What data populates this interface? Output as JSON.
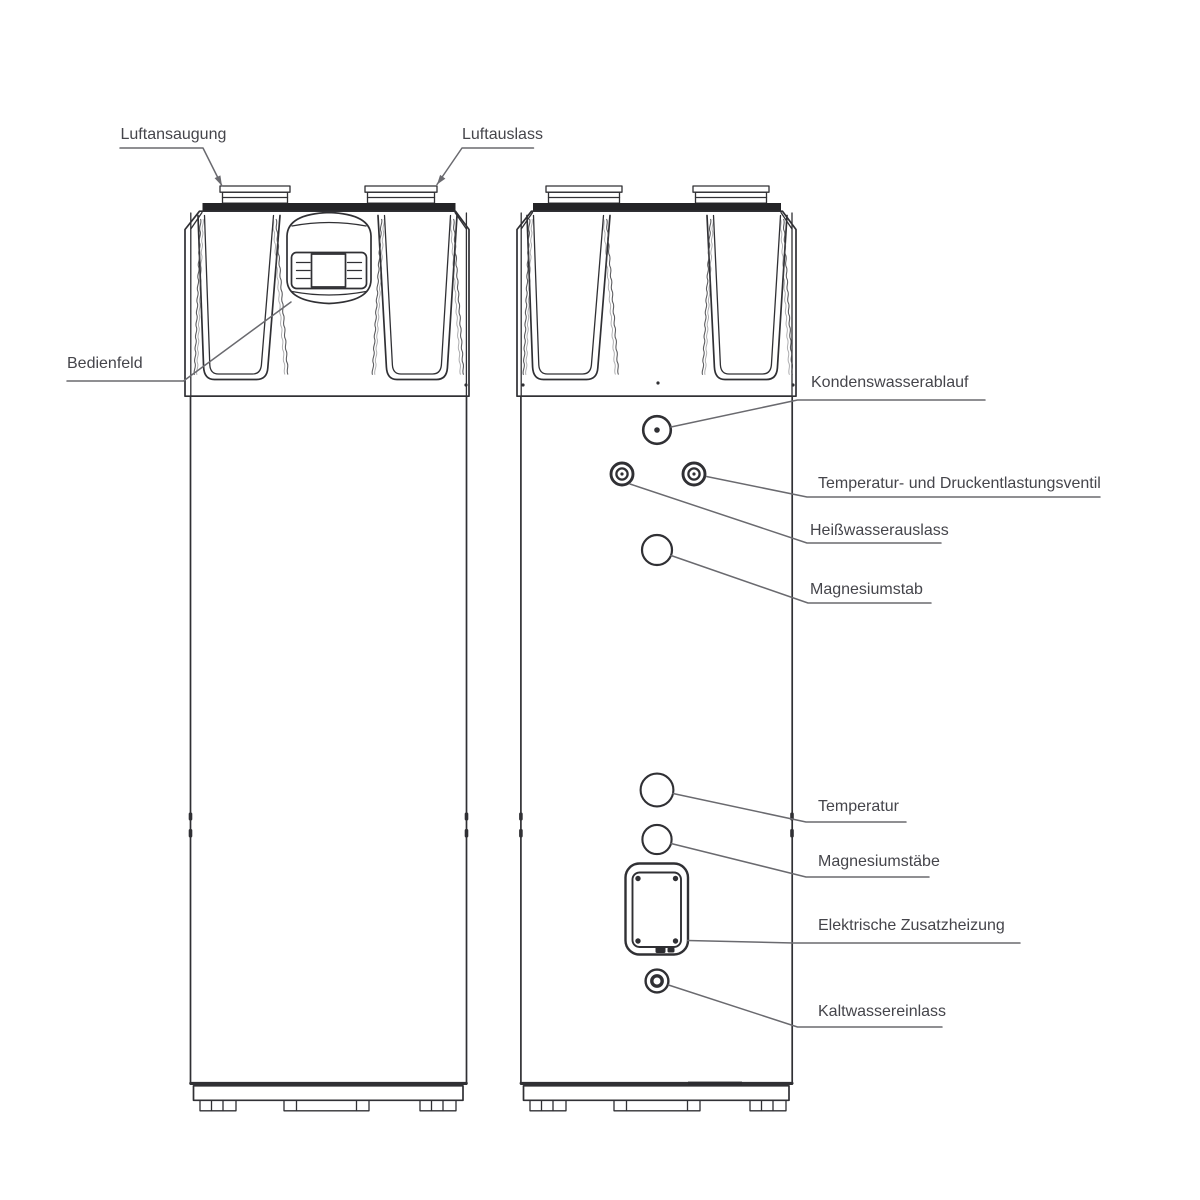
{
  "colors": {
    "background": "#ffffff",
    "outline": "#303034",
    "dark_band": "#232326",
    "leader": "#6a6a6f",
    "label_text": "#45454b",
    "texture": "#4b4b4f"
  },
  "labels": {
    "luftansaugung": "Luftansaugung",
    "luftauslass": "Luftauslass",
    "bedienfeld": "Bedienfeld",
    "kondenswasserablauf": "Kondenswasserablauf",
    "temperatur_druckventil": "Temperatur- und Druckentlastungsventil",
    "heisswasserauslass": "Heißwasserauslass",
    "magnesiumstab": "Magnesiumstab",
    "temperatur": "Temperatur",
    "magnesiumstaebe": "Magnesiumstäbe",
    "elektrische_zusatzheizung": "Elektrische Zusatzheizung",
    "kaltwassereinlass": "Kaltwassereinlass"
  }
}
